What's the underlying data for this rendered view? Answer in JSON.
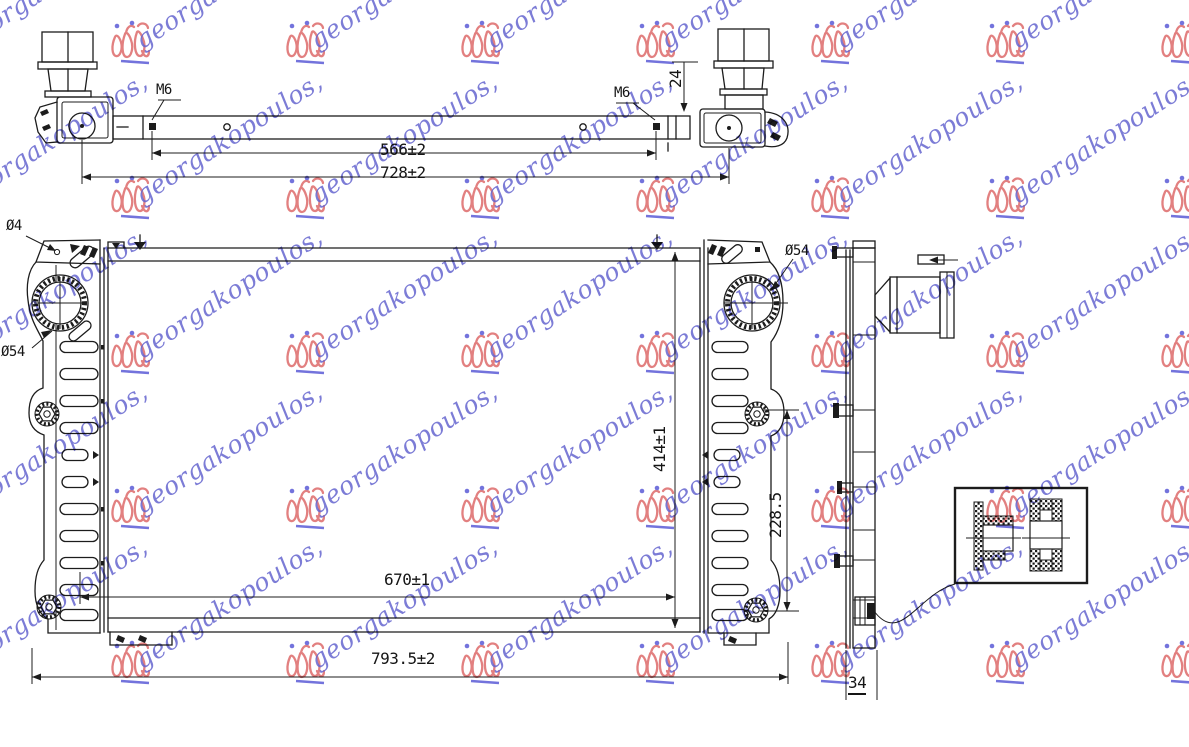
{
  "document": {
    "type": "technical-drawing",
    "background": "#ffffff",
    "line_color": "#1c1c1c"
  },
  "labels": {
    "m6_left": "M6",
    "m6_right": "M6",
    "dim_24": "24",
    "dim_566": "566±2",
    "dim_728": "728±2",
    "dia_4": "Ø4",
    "dia_54_left": "Ø54",
    "dia_54_right": "Ø54",
    "dim_414": "414±1",
    "dim_228_5": "228.5",
    "dim_670": "670±1",
    "dim_793_5": "793.5±2",
    "dim_34": "34"
  },
  "watermark": {
    "text": "georgakopoulos,",
    "text_color": "#6565cf",
    "logo_color": "#dd6a6a",
    "accent_color": "#5b5bd6"
  }
}
